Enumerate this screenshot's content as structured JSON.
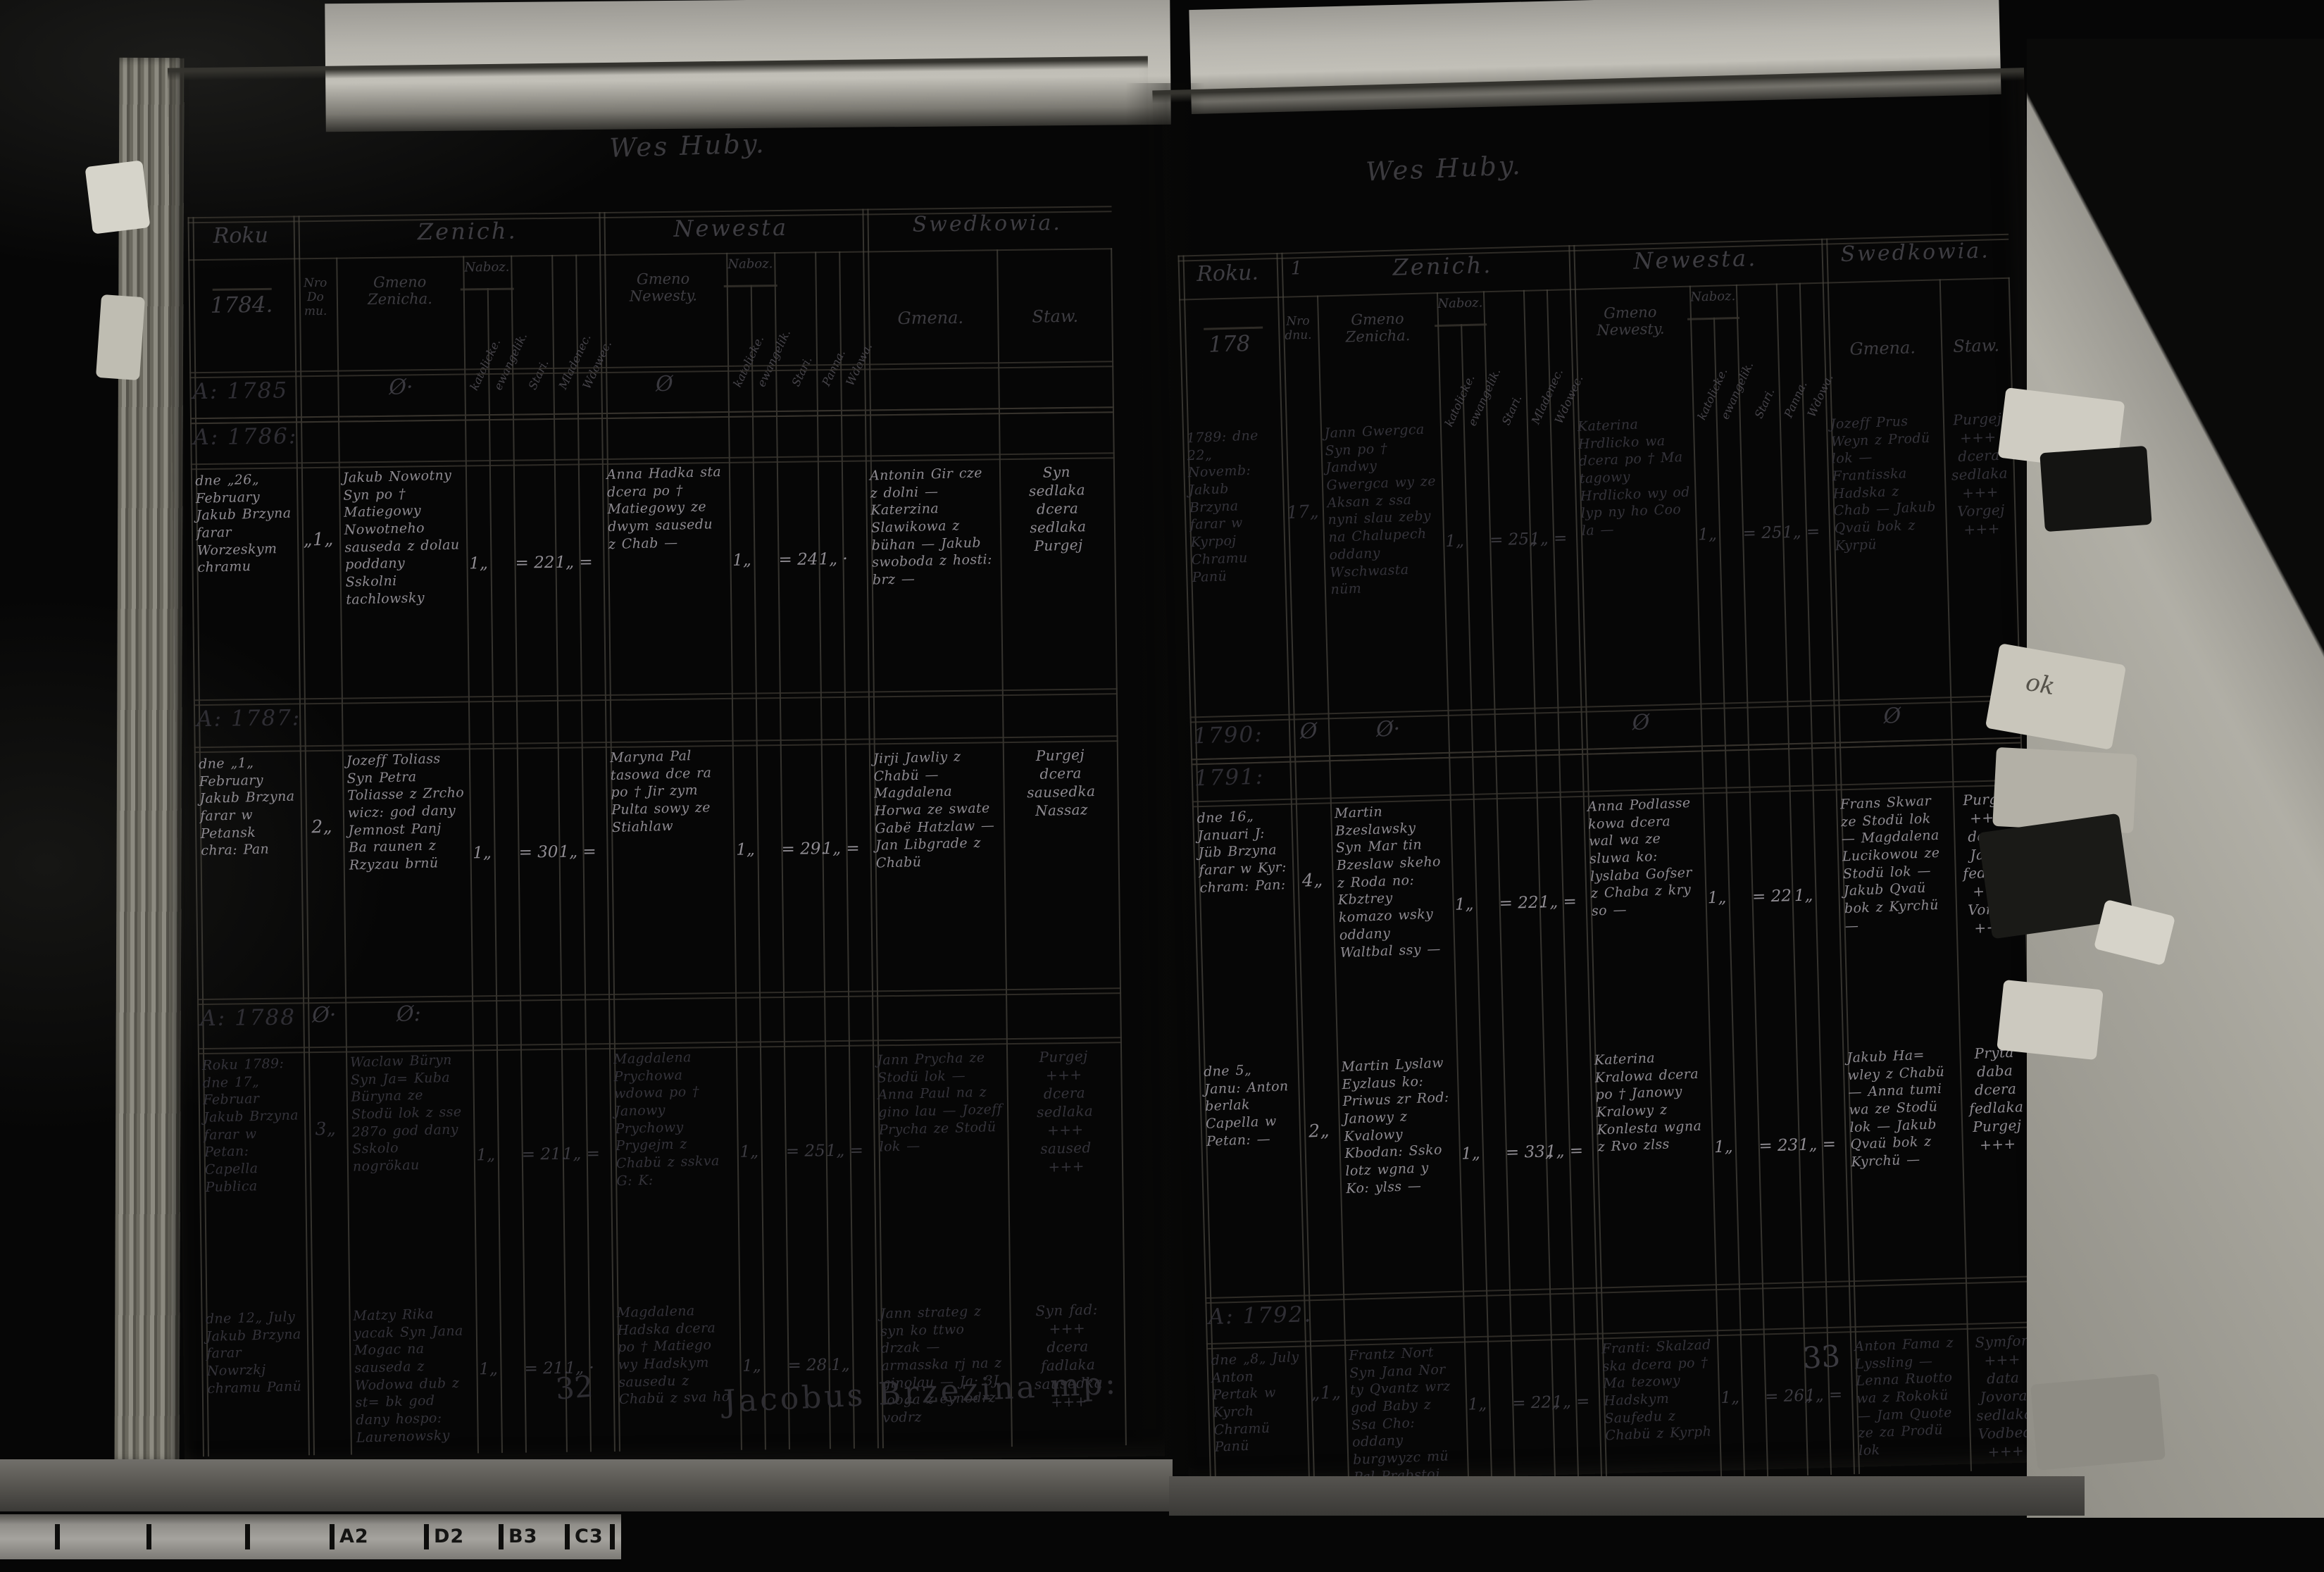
{
  "film": {
    "ruler_labels": [
      "A2",
      "D2",
      "B3",
      "C3"
    ],
    "tab_fragment": "ok"
  },
  "pages": {
    "left": {
      "title": "Wes Huby.",
      "signature": "Jacobus Brzezina mp:",
      "corner_note": "32",
      "header": {
        "roku": "Roku",
        "year_under": "1784.",
        "zenich": "Zenich.",
        "newesta": "Newesta",
        "swedkowia": "Swedkowia.",
        "nro_domu": "Nro\nDo\nmu.",
        "gmeno_zenicha": "Gmeno\nZenicha.",
        "naboz": "Naboz.",
        "katolik": "katolicke.",
        "ewangelik": "ewangelik.",
        "stari": "Stari.",
        "mladenec": "Mladenec.",
        "wdowec": "Wdowec.",
        "gmeno_newesty": "Gmeno\nNewesty.",
        "panna": "Panna.",
        "wdowa": "Wdowa.",
        "gmena": "Gmena.",
        "staw": "Staw."
      },
      "sections": [
        {
          "id": "band-1785",
          "type": "band",
          "label": "A: 1785",
          "zeros": [
            {
              "col": "groom",
              "mark": "Ø·"
            },
            {
              "col": "bride",
              "mark": "Ø"
            }
          ]
        },
        {
          "id": "band-1786",
          "type": "band",
          "label": "A: 1786:"
        },
        {
          "id": "e-1786",
          "type": "entry",
          "ink": "faint",
          "date": "dne „26„ February Jakub Brzyna farar Worzeskym chramu",
          "house": "„1„",
          "groom": "Jakub Nowotny Syn po † Matiegowy Nowotneho sauseda z dolau poddany Sskolni tachlowsky",
          "g_marks": [
            "1„",
            "= 22",
            "1„ ="
          ],
          "bride": "Anna Hadka sta dcera po † Matiegowy ze dwym sausedu z Chab —",
          "b_marks": [
            "1„",
            "= 24",
            "1„ ·"
          ],
          "witnesses": "Antonin Gir cze z dolni — Katerzina Slawikowa z bühan — Jakub swoboda z hosti: brz —",
          "staw": "Syn\nsedlaka\ndcera\nsedlaka\nPurgej"
        },
        {
          "id": "band-1787",
          "type": "band",
          "label": "A: 1787:"
        },
        {
          "id": "e-1787",
          "type": "entry",
          "ink": "faint",
          "date": "dne „1„ February Jakub Brzyna farar w Petansk chra: Pan",
          "house": "2„",
          "groom": "Jozeff Toliass Syn Petra Toliasse z Zrcho wicz: god dany Jemnost Panj Ba raunen z Rzyzau brnü",
          "g_marks": [
            "1„",
            "= 30",
            "1„ ="
          ],
          "bride": "Maryna Pal tasowa dce ra po † Jir zym Pulta sowy ze Stiahlaw",
          "b_marks": [
            "1„",
            "= 29.",
            "1„ ="
          ],
          "witnesses": "Jirji Jawliy z Chabü — Magdalena Horwa ze swate Gabë Hatzlaw — Jan Libgrade z Chabü",
          "staw": "Purgej\ndcera\nsausedka\nNassaz"
        },
        {
          "id": "band-1788",
          "type": "band",
          "label": "A: 1788",
          "zeros": [
            {
              "col": "nro",
              "mark": "Ø·"
            },
            {
              "col": "groom",
              "mark": "Ø:"
            }
          ]
        },
        {
          "id": "e-1789",
          "type": "entry",
          "ink": "dark",
          "date": "Roku 1789: dne 17„ Februar Jakub Brzyna farar w Petan: Capella Publica",
          "house": "3„",
          "groom": "Waclaw Büryn Syn Ja= Kuba Büryna ze Stodü lok z sse 287o god dany Sskolo nogrökau",
          "g_marks": [
            "1„",
            "= 21.",
            "1„ ="
          ],
          "bride": "Magdalena Prychowa wdowa po † Janowy Prychowy Prygejm z Chabü z sskva G: K:",
          "b_marks": [
            "1„",
            "= 25",
            "1„ ="
          ],
          "witnesses": "Jann Prycha ze Stodü lok — Anna Paul na z gino lau — Jozeff Prycha ze Stodü lok —",
          "staw": "Purgej\n+++\ndcera\nsedlaka\n+++\nsaused\n+++"
        },
        {
          "id": "e-jul",
          "type": "entry",
          "ink": "dark",
          "date": "dne 12„ July Jakub Brzyna farar Nowrzkj chramu Panü",
          "house": "",
          "groom": "Matzy Rika yacak Syn Jana Mogac na sauseda z Wodowa dub z st= bk god dany hospo: Laurenowsky",
          "g_marks": [
            "1„",
            "= 21.",
            "1„ ·"
          ],
          "bride": "Magdalena Hadska dcera po † Matiego wy Hadskym sausedu z Chabü z sva ho",
          "b_marks": [
            "1„",
            "= 28.",
            "1„"
          ],
          "witnesses": "Jann strateg z syn ko ttwo drzak — armasska rj na z ginolau — Ja: 3J looga z eynodrz vodrz",
          "staw": "Syn fad:\n+++\ndcera\nfadlaka\nsausedka\n+++"
        }
      ]
    },
    "right": {
      "title": "Wes Huby.",
      "page_note": "33",
      "header": {
        "roku": "Roku.",
        "mark": "1",
        "year_under": "178",
        "zenich": "Zenich.",
        "newesta": "Newesta.",
        "swedkowia": "Swedkowia.",
        "nro_domu": "Nro\ndnu.",
        "gmeno_zenicha": "Gmeno\nZenicha.",
        "naboz": "Naboz.",
        "katolik": "katolicke.",
        "ewangelik": "ewangelik.",
        "stari": "Stari.",
        "mladenec": "Mladenec.",
        "wdowec": "Wdowec.",
        "gmeno_newesty": "Gmeno\nNewesty.",
        "panna": "Panna.",
        "wdowa": "Wdowa.",
        "gmena": "Gmena.",
        "staw": "Staw."
      },
      "sections": [
        {
          "id": "e-1789",
          "type": "entry",
          "ink": "dark",
          "date": "1789: dne 22„ Novemb: Jakub Brzyna farar w Kyrpoj Chramu Panü",
          "house": "17„",
          "groom": "Jann Gwergca Syn po † Jandwy Gwergca wy ze Aksan z ssa nyni slau zeby na Chalupech oddany Wschwasta nüm",
          "g_marks": [
            "1„",
            "= 25„",
            "1„ ="
          ],
          "bride": "Katerina Hrdlicko wa dcera po † Ma tagowy Hrdlicko wy od lyp ny ho Coo la —",
          "b_marks": [
            "1„",
            "= 25",
            "1„ ="
          ],
          "witnesses": "Jozeff Prus Weyn z Prodü lok — Frantisska Hadska z Chab — Jakub Qvaü bok z Kyrpü",
          "staw": "Purgej\n+++\ndcera\nsedlaka\n+++\nVorgej\n+++"
        },
        {
          "id": "band-1790",
          "type": "band",
          "label": "1790:",
          "zeros": [
            {
              "col": "nro",
              "mark": "Ø"
            },
            {
              "col": "groom",
              "mark": "Ø·"
            },
            {
              "col": "bride",
              "mark": "Ø"
            },
            {
              "col": "wit",
              "mark": "Ø"
            }
          ]
        },
        {
          "id": "band-1791",
          "type": "band",
          "label": "1791:"
        },
        {
          "id": "e-1791a",
          "type": "entry",
          "ink": "faint",
          "date": "dne 16„ Januari J: Jüb Brzyna farar w Kyr: chram: Pan:",
          "house": "4„",
          "groom": "Martin Bzeslawsky Syn Mar tin Bzeslaw skeho z Roda no: Kbztrey komazo wsky oddany Waltbal ssy —",
          "g_marks": [
            "1„",
            "= 22.",
            "1„ ="
          ],
          "bride": "Anna Podlasse kowa dcera wal wa ze sluwa ko: lyslaba Gofser z Chaba z kry so —",
          "b_marks": [
            "1„",
            "= 22",
            "1„"
          ],
          "witnesses": "Frans Skwar ze Stodü lok — Magdalena Lucikowou ze Stodü lok — Jakub Qvaü bok z Kyrchü —",
          "staw": "Purgej\n+++\ndcera\nJaroy\nfedlaka\n+++\nVorgej\n+++"
        },
        {
          "id": "e-1791b",
          "type": "entry",
          "ink": "faint",
          "date": "dne 5„ Janu: Anton berlak Capella w Petan: —",
          "house": "2„",
          "groom": "Martin Lyslaw Eyzlaus ko: Priwus zr Rod: Janowy z Kvalowy Kbodan: Ssko lotz wgna y Ko: ylss —",
          "g_marks": [
            "1„",
            "= 33„",
            "1„ ="
          ],
          "bride": "Katerina Kralowa dcera po † Janowy Kralowy z Konlesta wgna z Rvo zlss",
          "b_marks": [
            "1„",
            "= 23",
            "1„ ="
          ],
          "witnesses": "Jakub Ha= wley z Chabü — Anna tumi wa ze Stodü lok — Jakub Qvaü bok z Kyrchü —",
          "staw": "Pryta\ndaba\ndcera\nfedlaka\nPurgej\n+++"
        },
        {
          "id": "band-1792",
          "type": "band",
          "label": "A: 1792."
        },
        {
          "id": "e-1792",
          "type": "entry",
          "ink": "dark",
          "date": "dne „8„ July Anton Pertak w Kyrch Chramü Panü",
          "house": "„1„",
          "groom": "Frantz Nort Syn Jana Nor ty Qvantz wrz god Baby z Ssa Cho: oddany burgwyzc mü Pal Prabstoj",
          "g_marks": [
            "1„",
            "= 22„",
            "1„ ="
          ],
          "bride": "Franti: Skalzad ska dcera po † Ma tezowy Hadskym Saufedu z Chabü z Kyrph",
          "b_marks": [
            "1„",
            "= 26„",
            "1„ ="
          ],
          "witnesses": "Anton Fama z Lyssling — Lenna Ruotto wa z Rokokü — Jam Quote ze za Prodü lok",
          "staw": "Symfor\n+++\ndata\nJovora\nsedlaka\nVodbed\n+++"
        }
      ]
    }
  }
}
